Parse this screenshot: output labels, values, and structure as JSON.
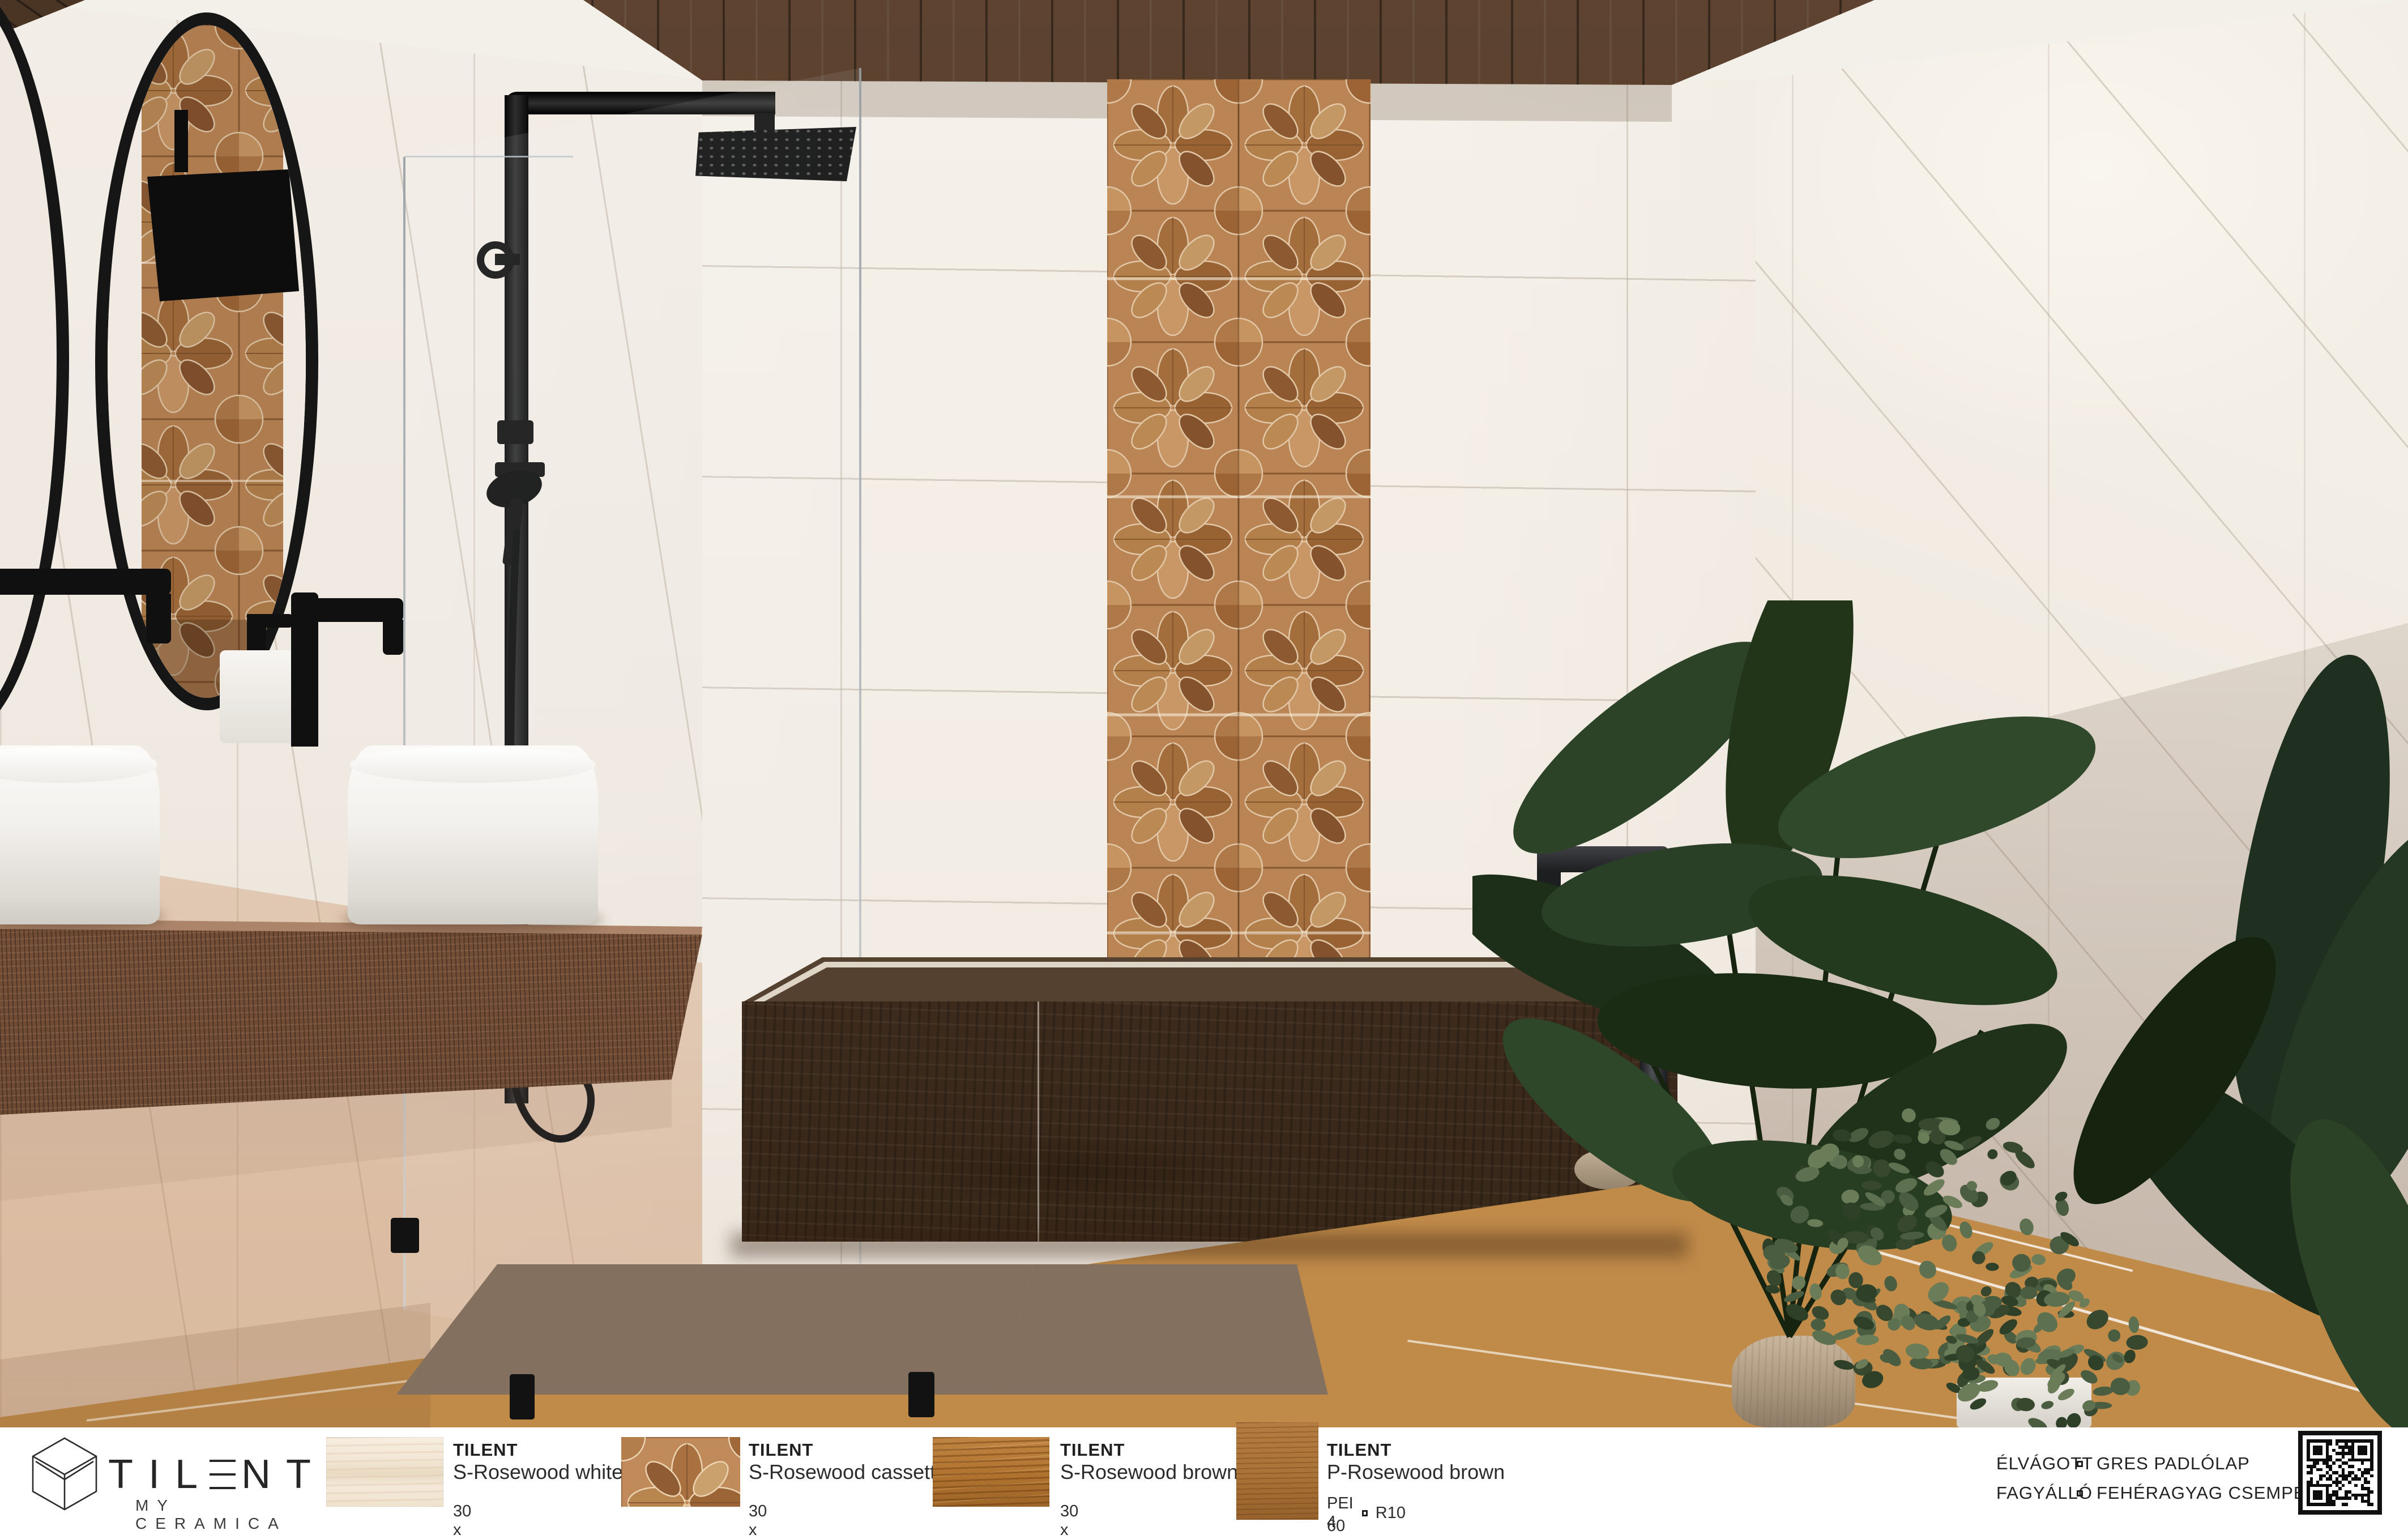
{
  "brand": {
    "name": "TILENT",
    "wordmark_pre": "TIL",
    "wordmark_post": "NT",
    "tagline": "MY CERAMICA"
  },
  "products": [
    {
      "brand": "TILENT",
      "name": "S-Rosewood white",
      "size": "30 x 60 cm",
      "swatch": "rosewood-white-tile"
    },
    {
      "brand": "TILENT",
      "name": "S-Rosewood cassette",
      "size": "30 x 60 cm",
      "swatch": "rosewood-cassette-tile"
    },
    {
      "brand": "TILENT",
      "name": "S-Rosewood brown",
      "size": "30 x 60 cm",
      "swatch": "rosewood-brown-tile"
    },
    {
      "brand": "TILENT",
      "name": "P-Rosewood brown",
      "rating": "PEI 4",
      "slip": "R10",
      "size": "60 x 60 cm",
      "swatch": "p-rosewood-brown-tile"
    }
  ],
  "specs": {
    "rows": [
      {
        "label": "ÉLVÁGOTT",
        "value": "GRES PADLÓLAP"
      },
      {
        "label": "FAGYÁLLÓ",
        "value": "FEHÉRAGYAG CSEMPE"
      }
    ]
  },
  "colors": {
    "accent_wood": "#c08a5a",
    "ceiling_wood": "#4a3424",
    "tub_wood": "#3f2d1e",
    "floor_wood": "#c08b49",
    "leaf_green": "#2a4026"
  }
}
